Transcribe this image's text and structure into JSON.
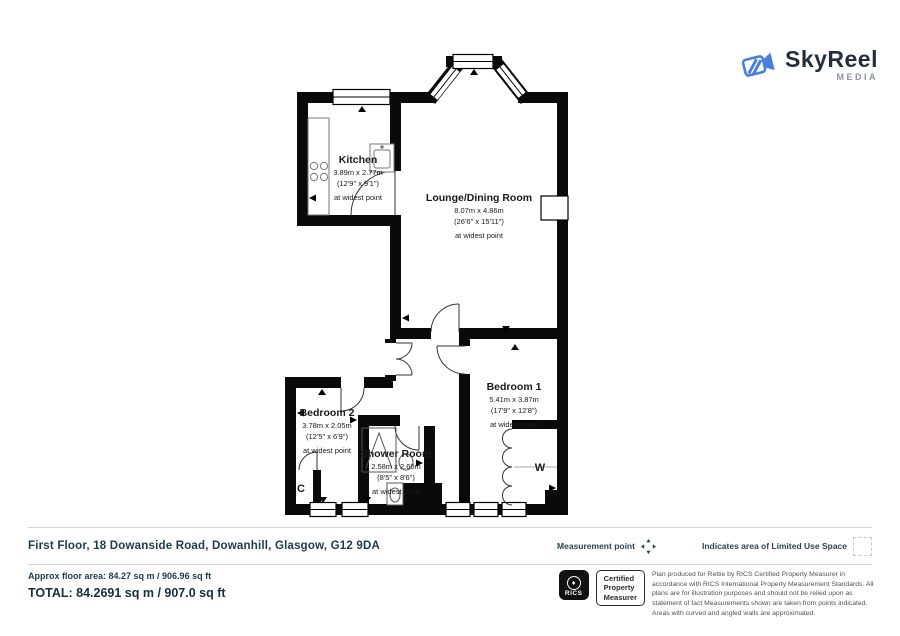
{
  "logo": {
    "name": "SkyReel",
    "tagline": "MEDIA"
  },
  "rooms": {
    "kitchen": {
      "name": "Kitchen",
      "dims_m": "3.89m x 2.77m",
      "dims_ft": "(12'9\" x 9'1\")",
      "note": "at widest point"
    },
    "lounge": {
      "name": "Lounge/Dining Room",
      "dims_m": "8.07m x 4.86m",
      "dims_ft": "(26'6\" x 15'11\")",
      "note": "at widest point"
    },
    "bedroom1": {
      "name": "Bedroom 1",
      "dims_m": "5.41m x 3.87m",
      "dims_ft": "(17'9\" x 12'8\")",
      "note": "at widest point"
    },
    "bedroom2": {
      "name": "Bedroom 2",
      "dims_m": "3.78m x 2.05m",
      "dims_ft": "(12'5\" x 6'9\")",
      "note": "at widest point"
    },
    "shower": {
      "name": "Shower Room",
      "dims_m": "2.58m x 2.60m",
      "dims_ft": "(8'5\" x 8'6\")",
      "note": "at widest point"
    },
    "cupboard_label": "C",
    "wardrobe_label": "W"
  },
  "footer": {
    "address": "First Floor, 18 Dowanside Road, Dowanhill, Glasgow, G12 9DA",
    "measurement_point_label": "Measurement point",
    "limited_use_label": "Indicates area of  Limited Use Space",
    "approx_area": "Approx floor area: 84.27 sq m / 906.96 sq ft",
    "total_area": "TOTAL: 84.2691 sq m / 907.0 sq ft",
    "rics_logo_text": "RICS",
    "certified_lines": [
      "Certified",
      "Property",
      "Measurer"
    ],
    "disclaimer": "Plan produced for Rettie by RICS Certified Property Measurer in accordance with RICS International Property Measurement Standards.  All plans are for illustration purposes and should not be relied upon as statement of fact Measurements shown are taken from points indicated. Areas with curved and angled walls are approximated."
  },
  "colors": {
    "wall": "#0a0a0a",
    "accent_blue": "#4a80d9",
    "text_dark": "#1b3b4b"
  }
}
